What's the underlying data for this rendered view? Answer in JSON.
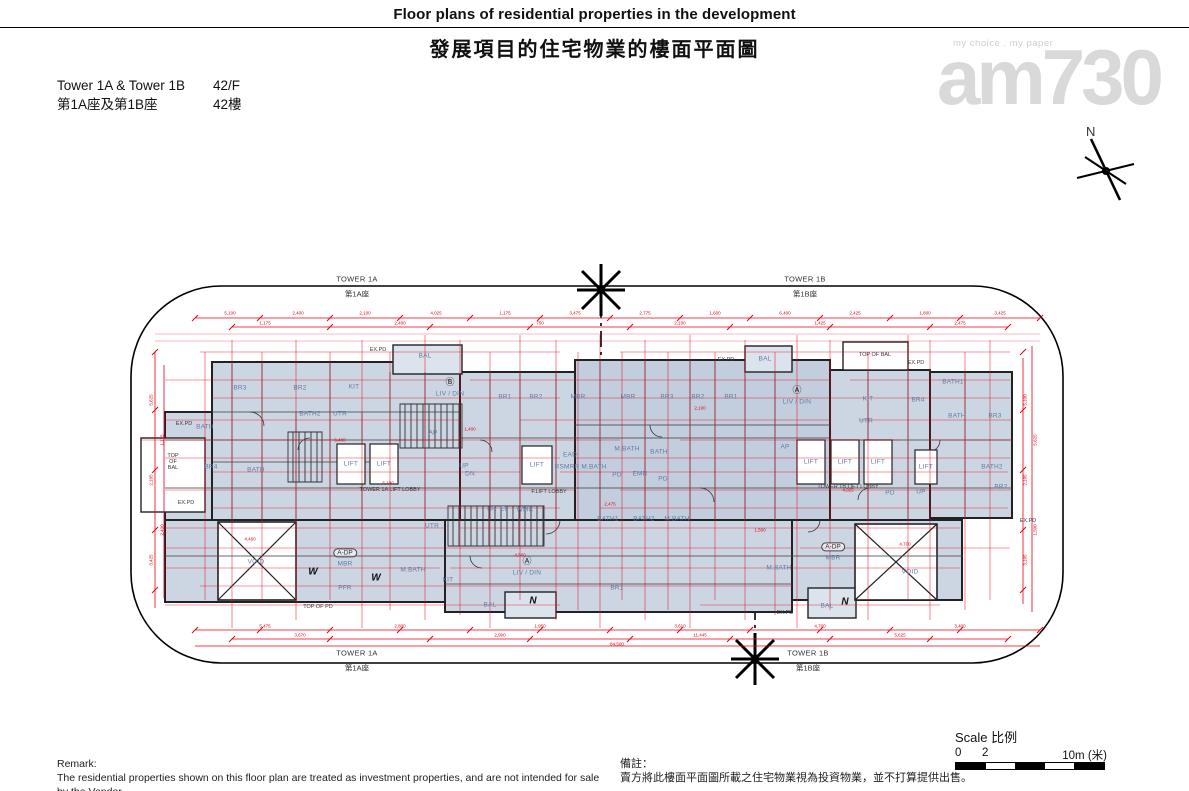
{
  "header": {
    "title_en": "Floor plans of residential properties in the development",
    "title_zh": "發展項目的住宅物業的樓面平面圖"
  },
  "info": {
    "towers_en": "Tower 1A & Tower 1B",
    "towers_zh": "第1A座及第1B座",
    "floor_en": "42/F",
    "floor_zh": "42樓"
  },
  "watermark": {
    "tagline": "my choice . my paper",
    "logo": "am730"
  },
  "compass": {
    "label": "N"
  },
  "plan": {
    "boundary_labels": [
      {
        "en": "TOWER 1A",
        "zh": "第1A座",
        "x": 357,
        "y": 287
      },
      {
        "en": "TOWER 1B",
        "zh": "第1B座",
        "x": 805,
        "y": 287
      },
      {
        "en": "TOWER 1A",
        "zh": "第1A座",
        "x": 357,
        "y": 661
      },
      {
        "en": "TOWER 1B",
        "zh": "第1B座",
        "x": 808,
        "y": 661
      }
    ],
    "labels": [
      {
        "t": "BAL",
        "x": 425,
        "y": 356
      },
      {
        "t": "BR3",
        "x": 240,
        "y": 388
      },
      {
        "t": "BR2",
        "x": 300,
        "y": 388
      },
      {
        "t": "KIT",
        "x": 354,
        "y": 387
      },
      {
        "t": "BATH2",
        "x": 310,
        "y": 414
      },
      {
        "t": "UTR",
        "x": 340,
        "y": 414
      },
      {
        "t": "BATH",
        "x": 205,
        "y": 427
      },
      {
        "t": "AP",
        "x": 433,
        "y": 433
      },
      {
        "t": "Ⓑ",
        "x": 450,
        "y": 383,
        "cls": "circ"
      },
      {
        "t": "LIV / DIN",
        "x": 450,
        "y": 394
      },
      {
        "t": "BR1",
        "x": 505,
        "y": 397
      },
      {
        "t": "BR2",
        "x": 536,
        "y": 397
      },
      {
        "t": "MBR",
        "x": 578,
        "y": 397
      },
      {
        "t": "MBR",
        "x": 628,
        "y": 397
      },
      {
        "t": "BR3",
        "x": 667,
        "y": 397
      },
      {
        "t": "BR2",
        "x": 698,
        "y": 397
      },
      {
        "t": "BR1",
        "x": 731,
        "y": 397
      },
      {
        "t": "BAL",
        "x": 765,
        "y": 359
      },
      {
        "t": "Ⓐ",
        "x": 797,
        "y": 391,
        "cls": "circ"
      },
      {
        "t": "LIV / DIN",
        "x": 797,
        "y": 402
      },
      {
        "t": "KIT",
        "x": 868,
        "y": 399
      },
      {
        "t": "BR4",
        "x": 918,
        "y": 400
      },
      {
        "t": "UTR",
        "x": 866,
        "y": 421
      },
      {
        "t": "BATH1",
        "x": 953,
        "y": 382
      },
      {
        "t": "BATH",
        "x": 957,
        "y": 416
      },
      {
        "t": "BR3",
        "x": 995,
        "y": 416
      },
      {
        "t": "BR4",
        "x": 211,
        "y": 467
      },
      {
        "t": "BATH",
        "x": 256,
        "y": 470
      },
      {
        "t": "LIFT",
        "x": 351,
        "y": 464
      },
      {
        "t": "LIFT",
        "x": 384,
        "y": 464
      },
      {
        "t": "LIFT",
        "x": 537,
        "y": 465
      },
      {
        "t": "UP",
        "x": 464,
        "y": 466
      },
      {
        "t": "DN",
        "x": 470,
        "y": 474
      },
      {
        "t": "EAD",
        "x": 570,
        "y": 455
      },
      {
        "t": "RSMRR",
        "x": 567,
        "y": 467
      },
      {
        "t": "M.BATH",
        "x": 594,
        "y": 467
      },
      {
        "t": "M.BATH",
        "x": 627,
        "y": 449
      },
      {
        "t": "BATH",
        "x": 659,
        "y": 452
      },
      {
        "t": "PD",
        "x": 617,
        "y": 475
      },
      {
        "t": "EMR",
        "x": 640,
        "y": 474
      },
      {
        "t": "PD",
        "x": 663,
        "y": 479
      },
      {
        "t": "AP",
        "x": 785,
        "y": 447
      },
      {
        "t": "LIFT",
        "x": 811,
        "y": 462
      },
      {
        "t": "LIFT",
        "x": 845,
        "y": 462
      },
      {
        "t": "LIFT",
        "x": 878,
        "y": 462
      },
      {
        "t": "LIFT",
        "x": 926,
        "y": 467
      },
      {
        "t": "BATH2",
        "x": 992,
        "y": 467
      },
      {
        "t": "BR2",
        "x": 1001,
        "y": 487
      },
      {
        "t": "HR",
        "x": 492,
        "y": 509
      },
      {
        "t": "EL",
        "x": 504,
        "y": 509
      },
      {
        "t": "WMC",
        "x": 525,
        "y": 510
      },
      {
        "t": "UTR",
        "x": 432,
        "y": 526
      },
      {
        "t": "BATH1",
        "x": 608,
        "y": 519
      },
      {
        "t": "BATH2",
        "x": 644,
        "y": 519
      },
      {
        "t": "M.BATH",
        "x": 677,
        "y": 519
      },
      {
        "t": "PD",
        "x": 890,
        "y": 493
      },
      {
        "t": "UP",
        "x": 921,
        "y": 492
      },
      {
        "t": "MBR",
        "x": 345,
        "y": 564
      },
      {
        "t": "M.BATH",
        "x": 413,
        "y": 570
      },
      {
        "t": "PFR",
        "x": 345,
        "y": 588
      },
      {
        "t": "KIT",
        "x": 448,
        "y": 580
      },
      {
        "t": "Ⓐ",
        "x": 527,
        "y": 562,
        "cls": "circ"
      },
      {
        "t": "LIV / DIN",
        "x": 527,
        "y": 573
      },
      {
        "t": "BR1",
        "x": 617,
        "y": 588
      },
      {
        "t": "BAL",
        "x": 490,
        "y": 605
      },
      {
        "t": "MBR",
        "x": 833,
        "y": 558
      },
      {
        "t": "M.BATH",
        "x": 779,
        "y": 568
      },
      {
        "t": "VOID",
        "x": 256,
        "y": 562
      },
      {
        "t": "VOID",
        "x": 910,
        "y": 572
      },
      {
        "t": "BAL",
        "x": 827,
        "y": 606
      },
      {
        "t": "W",
        "x": 313,
        "y": 572,
        "cls": "sym"
      },
      {
        "t": "W",
        "x": 376,
        "y": 578,
        "cls": "sym"
      },
      {
        "t": "N",
        "x": 533,
        "y": 601,
        "cls": "sym"
      },
      {
        "t": "N",
        "x": 845,
        "y": 602,
        "cls": "sym"
      },
      {
        "t": "TOWER 1A LIFT LOBBY",
        "x": 390,
        "y": 490,
        "cls": "dk"
      },
      {
        "t": "F.LIFT LOBBY",
        "x": 549,
        "y": 492,
        "cls": "dk"
      },
      {
        "t": "TOWER 1B LIFT LOBBY",
        "x": 848,
        "y": 487,
        "cls": "dk"
      },
      {
        "t": "TOP\nOF\nBAL",
        "x": 173,
        "y": 462,
        "cls": "dk"
      },
      {
        "t": "TOP OF BAL",
        "x": 875,
        "y": 355,
        "cls": "dk"
      },
      {
        "t": "EX.PD",
        "x": 378,
        "y": 350,
        "cls": "dk"
      },
      {
        "t": "EX.PD",
        "x": 726,
        "y": 360,
        "cls": "dk"
      },
      {
        "t": "EX.PD",
        "x": 916,
        "y": 363,
        "cls": "dk"
      },
      {
        "t": "EX.PD",
        "x": 184,
        "y": 424,
        "cls": "dk"
      },
      {
        "t": "EX.PD",
        "x": 186,
        "y": 503,
        "cls": "dk"
      },
      {
        "t": "EX.PD",
        "x": 785,
        "y": 613,
        "cls": "dk"
      },
      {
        "t": "EX.PD",
        "x": 1028,
        "y": 521,
        "cls": "dk"
      },
      {
        "t": "TOP OF PD",
        "x": 318,
        "y": 607,
        "cls": "dk"
      },
      {
        "t": "A-DP",
        "x": 345,
        "y": 553,
        "cls": "oval"
      },
      {
        "t": "A-DP",
        "x": 833,
        "y": 547,
        "cls": "oval"
      }
    ],
    "dims": [
      {
        "t": "5,100",
        "x": 230,
        "y": 314
      },
      {
        "t": "2,400",
        "x": 298,
        "y": 314
      },
      {
        "t": "2,100",
        "x": 365,
        "y": 314
      },
      {
        "t": "4,025",
        "x": 436,
        "y": 314
      },
      {
        "t": "1,175",
        "x": 505,
        "y": 314
      },
      {
        "t": "3,475",
        "x": 575,
        "y": 314
      },
      {
        "t": "2,775",
        "x": 645,
        "y": 314
      },
      {
        "t": "1,600",
        "x": 715,
        "y": 314
      },
      {
        "t": "6,400",
        "x": 785,
        "y": 314
      },
      {
        "t": "2,425",
        "x": 855,
        "y": 314
      },
      {
        "t": "1,800",
        "x": 925,
        "y": 314
      },
      {
        "t": "3,425",
        "x": 1000,
        "y": 314
      },
      {
        "t": "1,175",
        "x": 265,
        "y": 324
      },
      {
        "t": "2,400",
        "x": 400,
        "y": 324
      },
      {
        "t": "750",
        "x": 540,
        "y": 324
      },
      {
        "t": "2,100",
        "x": 680,
        "y": 324
      },
      {
        "t": "1,425",
        "x": 820,
        "y": 324
      },
      {
        "t": "2,475",
        "x": 960,
        "y": 324
      },
      {
        "t": "5,475",
        "x": 265,
        "y": 627
      },
      {
        "t": "2,800",
        "x": 400,
        "y": 627
      },
      {
        "t": "1,950",
        "x": 540,
        "y": 627
      },
      {
        "t": "3,610",
        "x": 680,
        "y": 627
      },
      {
        "t": "4,700",
        "x": 820,
        "y": 627
      },
      {
        "t": "3,400",
        "x": 960,
        "y": 627
      },
      {
        "t": "3,670",
        "x": 300,
        "y": 636
      },
      {
        "t": "2,900",
        "x": 500,
        "y": 636
      },
      {
        "t": "11,445",
        "x": 700,
        "y": 636
      },
      {
        "t": "5,625",
        "x": 900,
        "y": 636
      },
      {
        "t": "84,500",
        "x": 617,
        "y": 645
      },
      {
        "t": "5,625",
        "x": 152,
        "y": 400,
        "r": 1
      },
      {
        "t": "2,105",
        "x": 152,
        "y": 480,
        "r": 1
      },
      {
        "t": "3,425",
        "x": 152,
        "y": 560,
        "r": 1
      },
      {
        "t": "1,175",
        "x": 163,
        "y": 440,
        "r": 1
      },
      {
        "t": "2,400",
        "x": 163,
        "y": 530,
        "r": 1
      },
      {
        "t": "5,100",
        "x": 1026,
        "y": 400,
        "r": 1
      },
      {
        "t": "2,105",
        "x": 1026,
        "y": 480,
        "r": 1
      },
      {
        "t": "3,105",
        "x": 1026,
        "y": 560,
        "r": 1
      },
      {
        "t": "5,625",
        "x": 1036,
        "y": 440,
        "r": 1
      },
      {
        "t": "1,500",
        "x": 1036,
        "y": 530,
        "r": 1
      },
      {
        "t": "6,100",
        "x": 388,
        "y": 484
      },
      {
        "t": "4,025",
        "x": 848,
        "y": 491
      },
      {
        "t": "4,700",
        "x": 905,
        "y": 545
      },
      {
        "t": "4,560",
        "x": 520,
        "y": 556
      },
      {
        "t": "4,460",
        "x": 250,
        "y": 540
      },
      {
        "t": "2,100",
        "x": 700,
        "y": 409
      },
      {
        "t": "1,400",
        "x": 470,
        "y": 430
      },
      {
        "t": "1,500",
        "x": 760,
        "y": 531
      },
      {
        "t": "5,400",
        "x": 340,
        "y": 441
      },
      {
        "t": "2,475",
        "x": 610,
        "y": 505
      }
    ]
  },
  "scale": {
    "label": "Scale 比例",
    "tick0": "0",
    "tick2": "2",
    "tick10": "10m (米)"
  },
  "remark": {
    "heading_en": "Remark:",
    "body_en": "The residential properties shown on this floor plan are treated as investment properties, and are not intended for sale by the Vendor.",
    "heading_zh": "備註：",
    "body_zh": "賣方將此樓面平面圖所載之住宅物業視為投資物業，並不打算提供出售。"
  },
  "colors": {
    "dim_red": "#e60012",
    "room_fill": "#ccd6e2",
    "room_fill_dark": "#c2cedd",
    "label_blue": "#5f7ca6"
  }
}
